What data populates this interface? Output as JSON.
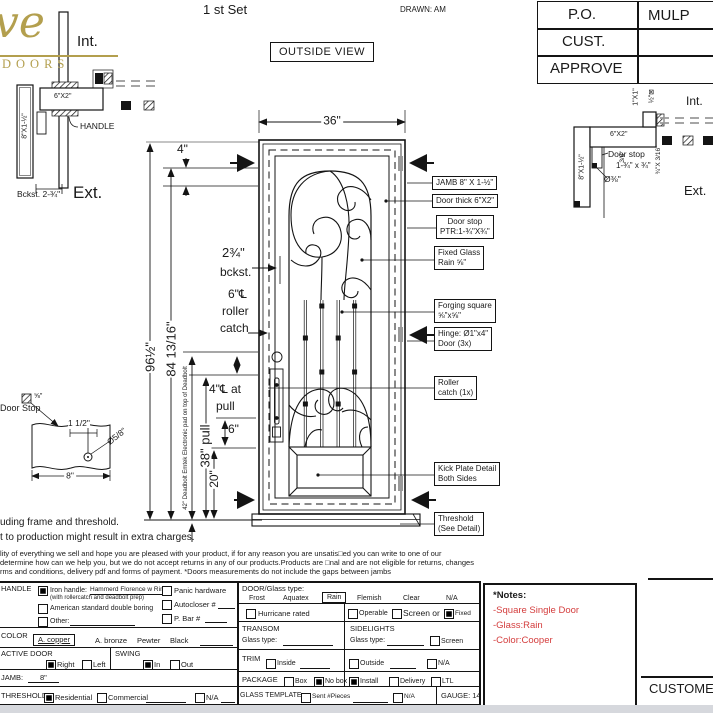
{
  "header": {
    "set_label": "1 st Set",
    "drawn": "DRAWN: AM",
    "outside_view": "OUTSIDE VIEW"
  },
  "logo": {
    "script": "ve",
    "word": "DOORS",
    "gold": "#b39f4e"
  },
  "approval": {
    "rows": [
      {
        "label": "P.O.",
        "value": "MULP"
      },
      {
        "label": "CUST.",
        "value": ""
      },
      {
        "label": "APPROVE",
        "value": ""
      }
    ]
  },
  "left_jamb": {
    "int_label": "Int.",
    "ext_label": "Ext.",
    "tube": "6\"X2\"",
    "vertical": "8\"X1-½\"",
    "handle": "HANDLE",
    "backset": "Bckst. 2-¾\""
  },
  "right_jamb": {
    "int_label": "Int.",
    "ext_label": "Ext.",
    "tube": "6\"X2\"",
    "vertical": "8\"X1-½\"",
    "one_by_one": "1\"X1\"",
    "half_plate": "½\"⊠",
    "three_eighth": "3/8\"",
    "bar": "¾\"X 3/16\"",
    "door_stop": "Door stop",
    "door_stop_size": "1-¾\" x ¾\"",
    "diameter": "Ø⅜\""
  },
  "dims": {
    "door_width": "36\"",
    "top_four": "4\"",
    "backset_val": "2¾\"",
    "backset_word": "bckst.",
    "roller_six": "6\"℄",
    "roller_word": "roller",
    "catch_word": "catch",
    "height_total": "96½\"",
    "height_glass": "84 13/16\"",
    "deadbolt_note": "42\" Deadbolt Emtek Electronic pad on top of Deadbolt",
    "at_pull_1": "4\"℄ at",
    "at_pull_2": "pull",
    "six": "6\"",
    "pull_38": "38\" pull",
    "twenty": "20\""
  },
  "callouts": [
    {
      "l1": "JAMB 8\" X 1-½\"",
      "l2": ""
    },
    {
      "l1": "Door thick 6\"X2\"",
      "l2": ""
    },
    {
      "l1": "Door stop",
      "l2": "PTR:1-¾\"X¾\""
    },
    {
      "l1": "Fixed Glass",
      "l2": "Rain ⅝\""
    },
    {
      "l1": "Forging square",
      "l2": "⅝\"x⅝\""
    },
    {
      "l1": "Hinge: Ø1\"x4\"",
      "l2": "Door (3x)"
    },
    {
      "l1": "Roller",
      "l2": "catch  (1x)"
    },
    {
      "l1": "Kick Plate Detail",
      "l2": "Both Sides"
    },
    {
      "l1": "Threshold",
      "l2": "(See Detail)"
    }
  ],
  "stop_detail": {
    "title": "Door Stop",
    "square": "⅝\"",
    "width_dim": "1 1/2\"",
    "diameter": "Ø5/8\"",
    "bottom_dim": "8\""
  },
  "disclaimer": {
    "big1": "uding frame and threshold.",
    "big2": "t to production might result in extra charges.",
    "small1": "lity of everything we sell and hope you are pleased with your product, if for any reason you are unsatis□ed you can write to one of our",
    "small2": "determine how can we help you, but we do not accept returns in any of our products.Products are □nal and are not eligible for returns, changes",
    "small3": "rms and conditions, delivery pdf and forms of payment. *Doors measurements do not include the gaps between jambs"
  },
  "form": {
    "handle_label": "HANDLE",
    "iron_handle": "Iron handle:",
    "iron_value": "Hammerd Florence w Rings",
    "iron_note": "(with rollercatch and deadbolt prep)",
    "american": "American standard double boring",
    "other": "Other:",
    "panic": "Panic hardware",
    "autocloser": "Autocloser #",
    "p_bar": "P. Bar #",
    "color_label": "COLOR",
    "copper": "A. copper",
    "bronze": "A. bronze",
    "pewter": "Pewter",
    "black": "Black",
    "active_label": "ACTIVE DOOR",
    "right": "Right",
    "left": "Left",
    "swing_label": "SWING",
    "swing_in": "In",
    "swing_out": "Out",
    "jamb_label": "JAMB:",
    "jamb_value": "8\"",
    "threshold_label": "THRESHOLD",
    "residential": "Residential",
    "commercial": "Commercial",
    "na": "N/A",
    "glass_label": "DOOR/Glass type:",
    "frost": "Frost",
    "aquatex": "Aquatex",
    "rain": "Rain",
    "flemish": "Flemish",
    "clear": "Clear",
    "glass_na": "N/A",
    "hurricane": "Hurricane rated",
    "operable": "Operable",
    "screen_or": "Screen or",
    "fixed": "Fixed",
    "transom_label": "TRANSOM",
    "transom_glass": "Glass type:",
    "sidelights_label": "SIDELIGHTS",
    "sidelights_glass": "Glass type:",
    "screen": "Screen",
    "trim_label": "TRIM",
    "inside": "Inside",
    "outside": "Outside",
    "trim_na": "N/A",
    "package_label": "PACKAGE",
    "box": "Box",
    "no_box": "No box",
    "install": "Install",
    "delivery": "Delivery",
    "ltl": "LTL",
    "template_label": "GLASS TEMPLATE",
    "sent": "Sent #Pieces",
    "template_na": "N/A",
    "gauge": "GAUGE: 14"
  },
  "notes": {
    "title": "*Notes:",
    "line1": "-Square Single Door",
    "line2": "-Glass:Rain",
    "line3": "-Color:Cooper",
    "red": "#d43d3d"
  },
  "customer_label": "CUSTOMER"
}
